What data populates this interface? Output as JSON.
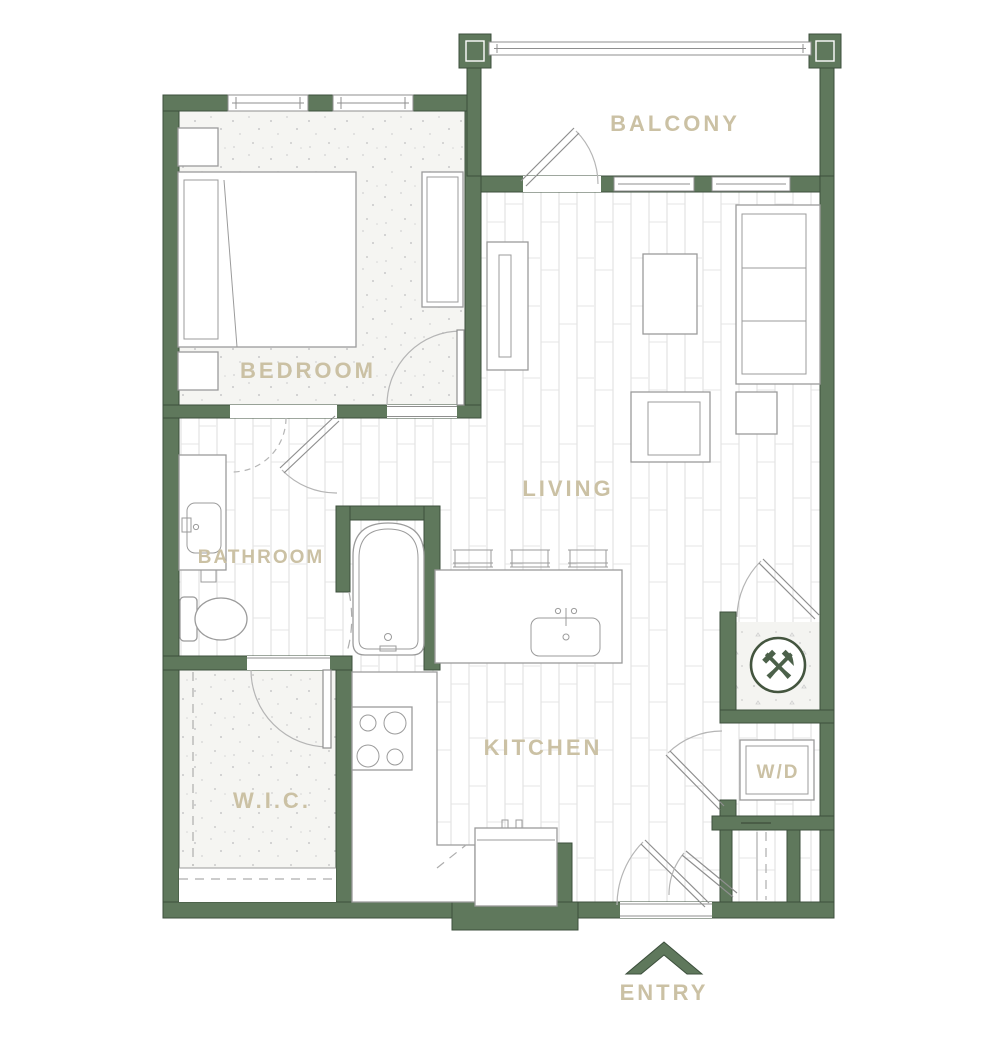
{
  "title": "One-bedroom apartment floor plan",
  "rooms": {
    "balcony": "BALCONY",
    "bedroom": "BEDROOM",
    "living": "LIVING",
    "bathroom": "BATHROOM",
    "wic": "W.I.C.",
    "kitchen": "KITCHEN",
    "washer_dryer": "W/D"
  },
  "entry": {
    "label": "ENTRY"
  },
  "icons": {
    "tools": "⚒"
  },
  "colors": {
    "wall": "#5f785c",
    "wall_outline": "#3c4f3c",
    "label": "#cbc1a4",
    "fixture_line": "#9b9b9b",
    "floor_line": "#dedede",
    "icon_green": "#4c614a"
  }
}
